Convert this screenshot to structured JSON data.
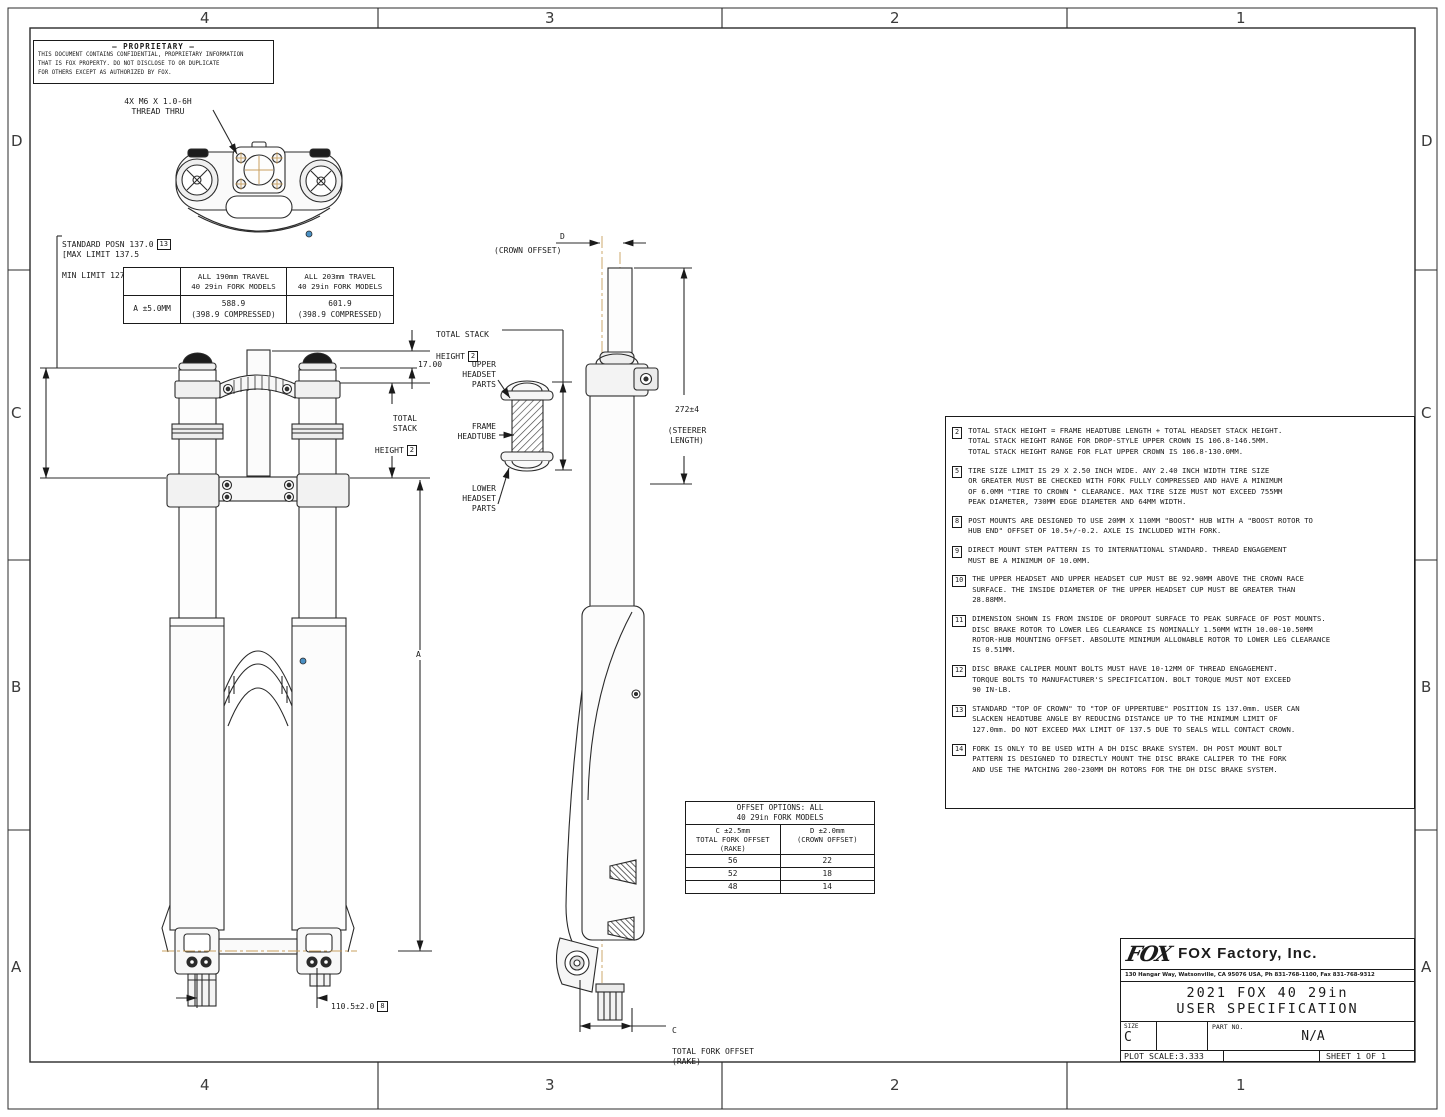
{
  "zones": {
    "cols": [
      "4",
      "3",
      "2",
      "1"
    ],
    "rows": [
      "D",
      "C",
      "B",
      "A"
    ]
  },
  "proprietary": {
    "title": "—  PROPRIETARY —",
    "body": "THIS DOCUMENT CONTAINS CONFIDENTIAL, PROPRIETARY INFORMATION\nTHAT IS FOX PROPERTY.  DO NOT DISCLOSE TO OR DUPLICATE\nFOR OTHERS EXCEPT AS AUTHORIZED BY FOX."
  },
  "callouts": {
    "thread_thru": "4X M6 X 1.0-6H\nTHREAD THRU",
    "standard_posn": "STANDARD POSN 137.0",
    "standard_posn_ref": "13",
    "max_limit": "[MAX LIMIT 137.5",
    "min_limit": "MIN LIMIT 127.0]",
    "crown_offset_letter": "D",
    "crown_offset": "(CROWN OFFSET)",
    "total_stack_1a": "TOTAL STACK",
    "total_stack_1b": "HEIGHT",
    "total_stack_1_ref": "2",
    "upper_headset": "UPPER\nHEADSET\nPARTS",
    "frame_headtube": "FRAME\nHEADTUBE",
    "lower_headset": "LOWER\nHEADSET\nPARTS",
    "dim_17": "17.00",
    "total_stack_2a": "TOTAL\nSTACK",
    "total_stack_2b": "HEIGHT",
    "total_stack_2_ref": "2",
    "steerer_length_val": "272±4",
    "steerer_length": "(STEERER LENGTH)",
    "dim_a": "A",
    "hub_spacing": "110.5±2.0",
    "hub_spacing_ref": "8",
    "rake_letter": "C",
    "rake_label": "TOTAL FORK OFFSET\n(RAKE)"
  },
  "travel_table": {
    "row_label": "A ±5.0MM",
    "headers": [
      "ALL 190mm TRAVEL\n40 29in FORK MODELS",
      "ALL 203mm TRAVEL\n40 29in FORK MODELS"
    ],
    "values": [
      "588.9\n(398.9 COMPRESSED)",
      "601.9\n(398.9 COMPRESSED)"
    ]
  },
  "offset_table": {
    "title": "OFFSET OPTIONS: ALL\n40 29in FORK MODELS",
    "col1_header": "C ±2.5mm\nTOTAL FORK OFFSET\n(RAKE)",
    "col2_header": "D ±2.0mm\n(CROWN OFFSET)",
    "rows": [
      [
        "56",
        "22"
      ],
      [
        "52",
        "18"
      ],
      [
        "48",
        "14"
      ]
    ]
  },
  "notes": [
    {
      "num": "2",
      "text": "TOTAL STACK HEIGHT = FRAME HEADTUBE LENGTH + TOTAL HEADSET STACK HEIGHT.\nTOTAL STACK HEIGHT RANGE FOR DROP-STYLE UPPER CROWN IS 106.8-146.5MM.\nTOTAL STACK HEIGHT RANGE FOR FLAT UPPER CROWN IS 106.8-130.0MM."
    },
    {
      "num": "5",
      "text": "TIRE SIZE LIMIT IS 29 X 2.50 INCH WIDE.  ANY 2.40 INCH WIDTH TIRE SIZE\nOR GREATER MUST BE CHECKED WITH FORK FULLY COMPRESSED AND HAVE A MINIMUM\nOF 6.0MM \"TIRE TO CROWN \" CLEARANCE. MAX TIRE SIZE MUST NOT EXCEED 755MM\nPEAK DIAMETER, 730MM EDGE DIAMETER AND 64MM WIDTH."
    },
    {
      "num": "8",
      "text": "POST MOUNTS ARE DESIGNED TO USE 20MM X 110MM \"BOOST\" HUB WITH A \"BOOST ROTOR TO\nHUB END\" OFFSET OF 10.5+/-0.2.  AXLE IS INCLUDED WITH FORK."
    },
    {
      "num": "9",
      "text": "DIRECT MOUNT STEM PATTERN IS TO INTERNATIONAL STANDARD. THREAD ENGAGEMENT\nMUST BE A MINIMUM OF 10.0MM."
    },
    {
      "num": "10",
      "text": "THE UPPER HEADSET AND UPPER HEADSET CUP MUST BE 92.90MM ABOVE THE CROWN RACE\nSURFACE. THE INSIDE DIAMETER OF THE UPPER HEADSET CUP MUST BE GREATER THAN\n28.88MM."
    },
    {
      "num": "11",
      "text": "DIMENSION SHOWN IS FROM INSIDE OF DROPOUT SURFACE TO PEAK SURFACE OF POST MOUNTS.\nDISC BRAKE ROTOR TO LOWER LEG CLEARANCE IS NOMINALLY 1.50MM WITH 10.00-10.50MM\nROTOR-HUB MOUNTING OFFSET. ABSOLUTE MINIMUM ALLOWABLE ROTOR TO LOWER LEG CLEARANCE\nIS 0.51MM."
    },
    {
      "num": "12",
      "text": "DISC BRAKE CALIPER MOUNT BOLTS MUST HAVE 10-12MM OF THREAD ENGAGEMENT.\nTORQUE BOLTS TO MANUFACTURER'S SPECIFICATION. BOLT TORQUE MUST NOT EXCEED\n90 IN-LB."
    },
    {
      "num": "13",
      "text": "STANDARD \"TOP OF CROWN\" TO \"TOP OF UPPERTUBE\" POSITION IS 137.0mm. USER CAN\nSLACKEN HEADTUBE ANGLE BY REDUCING DISTANCE UP TO THE MINIMUM LIMIT OF\n127.0mm. DO NOT EXCEED MAX LIMIT OF 137.5 DUE TO SEALS WILL CONTACT CROWN."
    },
    {
      "num": "14",
      "text": "FORK IS ONLY TO BE USED WITH A DH DISC BRAKE SYSTEM. DH POST MOUNT BOLT\nPATTERN IS DESIGNED TO DIRECTLY MOUNT THE DISC BRAKE CALIPER TO THE FORK\nAND USE THE MATCHING 200-230MM DH ROTORS FOR THE DH DISC BRAKE SYSTEM."
    }
  ],
  "title_block": {
    "logo_text": "FOX",
    "company": "FOX Factory, Inc.",
    "address": "130 Hangar Way, Watsonville, CA 95076 USA, Ph 831-768-1100, Fax 831-768-9312",
    "title_line1": "2021 FOX 40 29in",
    "title_line2": "USER SPECIFICATION",
    "size_label": "SIZE",
    "size_value": "C",
    "part_no_label": "PART NO.",
    "part_no_value": "N/A",
    "plot_scale": "PLOT SCALE:3.333",
    "sheet": "SHEET 1 OF 1"
  },
  "colors": {
    "line": "#2b2b2b",
    "centerline": "#c9a05f",
    "accent_blue": "#4a90c4"
  }
}
